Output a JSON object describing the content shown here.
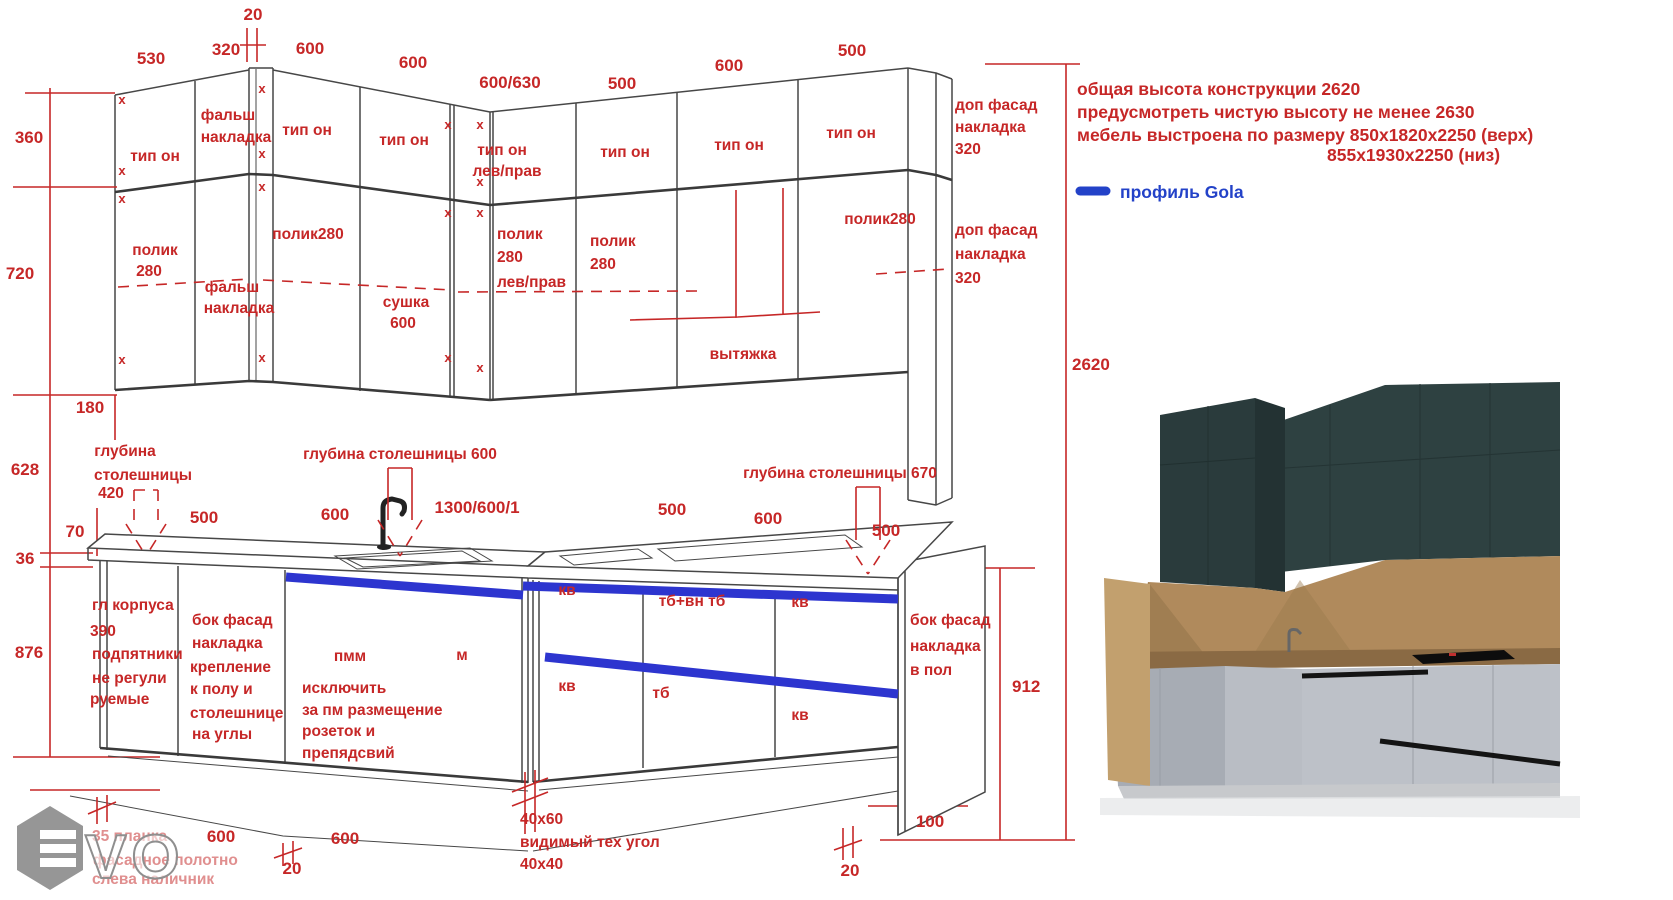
{
  "colors": {
    "red": "#c62727",
    "blue": "#2d35cf",
    "legend_blue": "#2342c8",
    "line": "#474747"
  },
  "legend": {
    "profile_label": "профиль Gola"
  },
  "notes": {
    "line1": "общая высота конструкции 2620",
    "line2": "предусмотреть чистую высоту не менее 2630",
    "line3": "мебель выстроена по размеру 850х1820х2250 (верх)",
    "line4": "855х1930х2250 (низ)"
  },
  "texts": [
    {
      "n": "dim-top-530",
      "t": "530",
      "x": 151,
      "y": 64,
      "c": "dim"
    },
    {
      "n": "dim-top-320",
      "t": "320",
      "x": 226,
      "y": 55,
      "c": "dim"
    },
    {
      "n": "dim-top-20",
      "t": "20",
      "x": 253,
      "y": 20,
      "c": "dim"
    },
    {
      "n": "dim-top-600a",
      "t": "600",
      "x": 310,
      "y": 54,
      "c": "dim"
    },
    {
      "n": "dim-top-600b",
      "t": "600",
      "x": 413,
      "y": 68,
      "c": "dim"
    },
    {
      "n": "dim-top-600-630",
      "t": "600/630",
      "x": 510,
      "y": 88,
      "c": "dim"
    },
    {
      "n": "dim-top-500a",
      "t": "500",
      "x": 622,
      "y": 89,
      "c": "dim"
    },
    {
      "n": "dim-top-600c",
      "t": "600",
      "x": 729,
      "y": 71,
      "c": "dim"
    },
    {
      "n": "dim-top-500b",
      "t": "500",
      "x": 852,
      "y": 56,
      "c": "dim"
    },
    {
      "n": "dim-left-360",
      "t": "360",
      "x": 29,
      "y": 143,
      "c": "dim"
    },
    {
      "n": "dim-left-720",
      "t": "720",
      "x": 20,
      "y": 279,
      "c": "dim"
    },
    {
      "n": "dim-left-180",
      "t": "180",
      "x": 90,
      "y": 413,
      "c": "dim"
    },
    {
      "n": "dim-left-628",
      "t": "628",
      "x": 25,
      "y": 475,
      "c": "dim"
    },
    {
      "n": "dim-left-70",
      "t": "70",
      "x": 75,
      "y": 537,
      "c": "dim"
    },
    {
      "n": "dim-left-36",
      "t": "36",
      "x": 25,
      "y": 564,
      "c": "dim"
    },
    {
      "n": "dim-left-876",
      "t": "876",
      "x": 29,
      "y": 658,
      "c": "dim"
    },
    {
      "n": "dim-right-2620",
      "t": "2620",
      "x": 1072,
      "y": 370,
      "c": "dimL"
    },
    {
      "n": "dim-right-912",
      "t": "912",
      "x": 1012,
      "y": 692,
      "c": "dimL"
    },
    {
      "n": "upper-label-tip-on-1",
      "t": "тип он",
      "x": 155,
      "y": 161,
      "c": "lbl"
    },
    {
      "n": "upper-label-falsh-1a",
      "t": "фальш",
      "x": 228,
      "y": 120,
      "c": "lbl"
    },
    {
      "n": "upper-label-falsh-1b",
      "t": "накладка",
      "x": 236,
      "y": 142,
      "c": "lbl"
    },
    {
      "n": "upper-label-tip-on-2",
      "t": "тип он",
      "x": 307,
      "y": 135,
      "c": "lbl"
    },
    {
      "n": "upper-label-tip-on-3",
      "t": "тип он",
      "x": 404,
      "y": 145,
      "c": "lbl"
    },
    {
      "n": "upper-label-tip-on-4a",
      "t": "тип он",
      "x": 502,
      "y": 155,
      "c": "lbl"
    },
    {
      "n": "upper-label-tip-on-4b",
      "t": "лев/прав",
      "x": 507,
      "y": 176,
      "c": "lbl"
    },
    {
      "n": "upper-label-tip-on-5",
      "t": "тип он",
      "x": 625,
      "y": 157,
      "c": "lbl"
    },
    {
      "n": "upper-label-tip-on-6",
      "t": "тип он",
      "x": 739,
      "y": 150,
      "c": "lbl"
    },
    {
      "n": "upper-label-tip-on-7",
      "t": "тип он",
      "x": 851,
      "y": 138,
      "c": "lbl"
    },
    {
      "n": "upper-label-dop-fasad-1a",
      "t": "доп фасад",
      "x": 955,
      "y": 110,
      "c": "lblL"
    },
    {
      "n": "upper-label-dop-fasad-1b",
      "t": "накладка",
      "x": 955,
      "y": 132,
      "c": "lblL"
    },
    {
      "n": "upper-label-dop-fasad-1c",
      "t": "320",
      "x": 955,
      "y": 154,
      "c": "lblL"
    },
    {
      "n": "upper-label-polik-1a",
      "t": "полик",
      "x": 155,
      "y": 255,
      "c": "lbl"
    },
    {
      "n": "upper-label-polik-1b",
      "t": "280",
      "x": 149,
      "y": 276,
      "c": "lbl"
    },
    {
      "n": "upper-label-falsh-2a",
      "t": "фальш",
      "x": 232,
      "y": 292,
      "c": "lbl"
    },
    {
      "n": "upper-label-falsh-2b",
      "t": "накладка",
      "x": 239,
      "y": 313,
      "c": "lbl"
    },
    {
      "n": "upper-label-polik-2",
      "t": "полик280",
      "x": 308,
      "y": 239,
      "c": "lbl"
    },
    {
      "n": "upper-label-polik-3a",
      "t": "полик",
      "x": 497,
      "y": 239,
      "c": "lblL"
    },
    {
      "n": "upper-label-polik-3b",
      "t": "280",
      "x": 497,
      "y": 262,
      "c": "lblL"
    },
    {
      "n": "upper-label-polik-3c",
      "t": "лев/прав",
      "x": 497,
      "y": 287,
      "c": "lblL"
    },
    {
      "n": "upper-label-sushka-a",
      "t": "сушка",
      "x": 406,
      "y": 307,
      "c": "lbl"
    },
    {
      "n": "upper-label-sushka-b",
      "t": "600",
      "x": 403,
      "y": 328,
      "c": "lbl"
    },
    {
      "n": "upper-label-polik-4a",
      "t": "полик",
      "x": 590,
      "y": 246,
      "c": "lblL"
    },
    {
      "n": "upper-label-polik-4b",
      "t": "280",
      "x": 590,
      "y": 269,
      "c": "lblL"
    },
    {
      "n": "upper-label-vytyazhka",
      "t": "вытяжка",
      "x": 743,
      "y": 359,
      "c": "lbl"
    },
    {
      "n": "upper-label-polik-5",
      "t": "полик280",
      "x": 880,
      "y": 224,
      "c": "lbl"
    },
    {
      "n": "upper-label-dop-fasad-2a",
      "t": "доп фасад",
      "x": 955,
      "y": 235,
      "c": "lblL"
    },
    {
      "n": "upper-label-dop-fasad-2b",
      "t": "накладка",
      "x": 955,
      "y": 259,
      "c": "lblL"
    },
    {
      "n": "upper-label-dop-fasad-2c",
      "t": "320",
      "x": 955,
      "y": 283,
      "c": "lblL"
    },
    {
      "n": "dim-base-500a",
      "t": "500",
      "x": 204,
      "y": 523,
      "c": "dim"
    },
    {
      "n": "dim-base-600a",
      "t": "600",
      "x": 335,
      "y": 520,
      "c": "dim"
    },
    {
      "n": "dim-base-1300",
      "t": "1300/600/1",
      "x": 477,
      "y": 513,
      "c": "dim"
    },
    {
      "n": "dim-base-500b",
      "t": "500",
      "x": 672,
      "y": 515,
      "c": "dim"
    },
    {
      "n": "dim-base-600b",
      "t": "600",
      "x": 768,
      "y": 524,
      "c": "dim"
    },
    {
      "n": "dim-base-500c",
      "t": "500",
      "x": 886,
      "y": 536,
      "c": "dim"
    },
    {
      "n": "base-depth-420a",
      "t": "глубина",
      "x": 125,
      "y": 456,
      "c": "lbl"
    },
    {
      "n": "base-depth-420b",
      "t": "столешницы",
      "x": 143,
      "y": 480,
      "c": "lbl"
    },
    {
      "n": "base-depth-420c",
      "t": "420",
      "x": 111,
      "y": 498,
      "c": "lbl"
    },
    {
      "n": "base-depth-600",
      "t": "глубина столешницы 600",
      "x": 400,
      "y": 459,
      "c": "lbl"
    },
    {
      "n": "base-depth-670",
      "t": "глубина столешницы 670",
      "x": 840,
      "y": 478,
      "c": "lbl"
    },
    {
      "n": "base-label-gl-a",
      "t": "гл корпуса",
      "x": 92,
      "y": 610,
      "c": "lblL"
    },
    {
      "n": "base-label-gl-b",
      "t": "390",
      "x": 90,
      "y": 636,
      "c": "lblL"
    },
    {
      "n": "base-label-gl-c",
      "t": "подпятники",
      "x": 92,
      "y": 659,
      "c": "lblL"
    },
    {
      "n": "base-label-gl-d",
      "t": "не регули",
      "x": 92,
      "y": 683,
      "c": "lblL"
    },
    {
      "n": "base-label-gl-e",
      "t": "руемые",
      "x": 90,
      "y": 704,
      "c": "lblL"
    },
    {
      "n": "base-label-bf1-a",
      "t": "бок фасад",
      "x": 192,
      "y": 625,
      "c": "lblL"
    },
    {
      "n": "base-label-bf1-b",
      "t": "накладка",
      "x": 192,
      "y": 648,
      "c": "lblL"
    },
    {
      "n": "base-label-bf1-c",
      "t": "крепление",
      "x": 190,
      "y": 672,
      "c": "lblL"
    },
    {
      "n": "base-label-bf1-d",
      "t": "к полу и",
      "x": 190,
      "y": 694,
      "c": "lblL"
    },
    {
      "n": "base-label-bf1-e",
      "t": "столешнице",
      "x": 190,
      "y": 718,
      "c": "lblL"
    },
    {
      "n": "base-label-bf1-f",
      "t": "на углы",
      "x": 192,
      "y": 739,
      "c": "lblL"
    },
    {
      "n": "base-label-pmm-a",
      "t": "пмм",
      "x": 350,
      "y": 661,
      "c": "lbl"
    },
    {
      "n": "base-label-pmm-b",
      "t": "исключить",
      "x": 302,
      "y": 693,
      "c": "lblL"
    },
    {
      "n": "base-label-pmm-c",
      "t": "за пм размещение",
      "x": 302,
      "y": 715,
      "c": "lblL"
    },
    {
      "n": "base-label-pmm-d",
      "t": "розеток и",
      "x": 302,
      "y": 736,
      "c": "lblL"
    },
    {
      "n": "base-label-pmm-e",
      "t": "препядсвий",
      "x": 302,
      "y": 758,
      "c": "lblL"
    },
    {
      "n": "base-label-m",
      "t": "м",
      "x": 462,
      "y": 660,
      "c": "lbl"
    },
    {
      "n": "base-label-kv-1",
      "t": "кв",
      "x": 567,
      "y": 595,
      "c": "lbl"
    },
    {
      "n": "base-label-tb-vn",
      "t": "тб+вн тб",
      "x": 692,
      "y": 606,
      "c": "lbl"
    },
    {
      "n": "base-label-kv-2",
      "t": "кв",
      "x": 800,
      "y": 607,
      "c": "lbl"
    },
    {
      "n": "base-label-kv-3",
      "t": "кв",
      "x": 567,
      "y": 691,
      "c": "lbl"
    },
    {
      "n": "base-label-tb",
      "t": "тб",
      "x": 661,
      "y": 698,
      "c": "lbl"
    },
    {
      "n": "base-label-kv-4",
      "t": "кв",
      "x": 800,
      "y": 720,
      "c": "lbl"
    },
    {
      "n": "base-label-bf2-a",
      "t": "бок фасад",
      "x": 910,
      "y": 625,
      "c": "lblL"
    },
    {
      "n": "base-label-bf2-b",
      "t": "накладка",
      "x": 910,
      "y": 651,
      "c": "lblL"
    },
    {
      "n": "base-label-bf2-c",
      "t": "в пол",
      "x": 910,
      "y": 675,
      "c": "lblL"
    },
    {
      "n": "dim-bottom-600a",
      "t": "600",
      "x": 221,
      "y": 842,
      "c": "dim"
    },
    {
      "n": "dim-bottom-20a",
      "t": "20",
      "x": 292,
      "y": 874,
      "c": "dim"
    },
    {
      "n": "dim-bottom-600b",
      "t": "600",
      "x": 345,
      "y": 844,
      "c": "dim"
    },
    {
      "n": "base-note-40x60",
      "t": "40x60",
      "x": 520,
      "y": 824,
      "c": "lblL"
    },
    {
      "n": "base-note-tehugol",
      "t": "видимый тех угол",
      "x": 520,
      "y": 847,
      "c": "lblL"
    },
    {
      "n": "base-note-40x40",
      "t": "40x40",
      "x": 520,
      "y": 869,
      "c": "lblL"
    },
    {
      "n": "dim-bottom-100",
      "t": "100",
      "x": 930,
      "y": 827,
      "c": "dim"
    },
    {
      "n": "dim-bottom-20b",
      "t": "20",
      "x": 850,
      "y": 876,
      "c": "dim"
    },
    {
      "n": "watermark-note-a",
      "t": "35 планка",
      "x": 92,
      "y": 841,
      "c": "faded"
    },
    {
      "n": "watermark-note-b",
      "t": "фасадное полотно",
      "x": 93,
      "y": 865,
      "c": "faded"
    },
    {
      "n": "watermark-note-c",
      "t": "слева наличник",
      "x": 92,
      "y": 884,
      "c": "faded"
    },
    {
      "n": "note-line-1",
      "t": "общая высота конструкции 2620",
      "x": 1077,
      "y": 95,
      "c": "note"
    },
    {
      "n": "note-line-2",
      "t": "предусмотреть чистую высоту не менее 2630",
      "x": 1077,
      "y": 118,
      "c": "note"
    },
    {
      "n": "note-line-3",
      "t": "мебель выстроена по размеру 850х1820х2250 (верх)",
      "x": 1077,
      "y": 141,
      "c": "note"
    },
    {
      "n": "note-line-4",
      "t": "855х1930х2250 (низ)",
      "x": 1327,
      "y": 161,
      "c": "note"
    },
    {
      "n": "legend-label",
      "t": "профиль Gola",
      "x": 1120,
      "y": 198,
      "c": "legend"
    },
    {
      "n": "watermark-vo",
      "t": "VO",
      "x": 85,
      "y": 878,
      "c": "wm"
    },
    {
      "n": "corner-mark-1",
      "t": "x",
      "x": 122,
      "y": 104,
      "c": "xm"
    },
    {
      "n": "corner-mark-2",
      "t": "x",
      "x": 122,
      "y": 175,
      "c": "xm"
    },
    {
      "n": "corner-mark-3",
      "t": "x",
      "x": 122,
      "y": 203,
      "c": "xm"
    },
    {
      "n": "corner-mark-4",
      "t": "x",
      "x": 122,
      "y": 364,
      "c": "xm"
    },
    {
      "n": "corner-mark-5",
      "t": "x",
      "x": 262,
      "y": 93,
      "c": "xm"
    },
    {
      "n": "corner-mark-6",
      "t": "x",
      "x": 262,
      "y": 158,
      "c": "xm"
    },
    {
      "n": "corner-mark-7",
      "t": "x",
      "x": 262,
      "y": 191,
      "c": "xm"
    },
    {
      "n": "corner-mark-8",
      "t": "x",
      "x": 262,
      "y": 362,
      "c": "xm"
    },
    {
      "n": "corner-mark-9",
      "t": "x",
      "x": 448,
      "y": 129,
      "c": "xm"
    },
    {
      "n": "corner-mark-10",
      "t": "x",
      "x": 448,
      "y": 217,
      "c": "xm"
    },
    {
      "n": "corner-mark-11",
      "t": "x",
      "x": 448,
      "y": 362,
      "c": "xm"
    },
    {
      "n": "corner-mark-12",
      "t": "x",
      "x": 480,
      "y": 129,
      "c": "xm"
    },
    {
      "n": "corner-mark-13",
      "t": "x",
      "x": 480,
      "y": 186,
      "c": "xm"
    },
    {
      "n": "corner-mark-14",
      "t": "x",
      "x": 480,
      "y": 217,
      "c": "xm"
    },
    {
      "n": "corner-mark-15",
      "t": "x",
      "x": 480,
      "y": 372,
      "c": "xm"
    }
  ]
}
